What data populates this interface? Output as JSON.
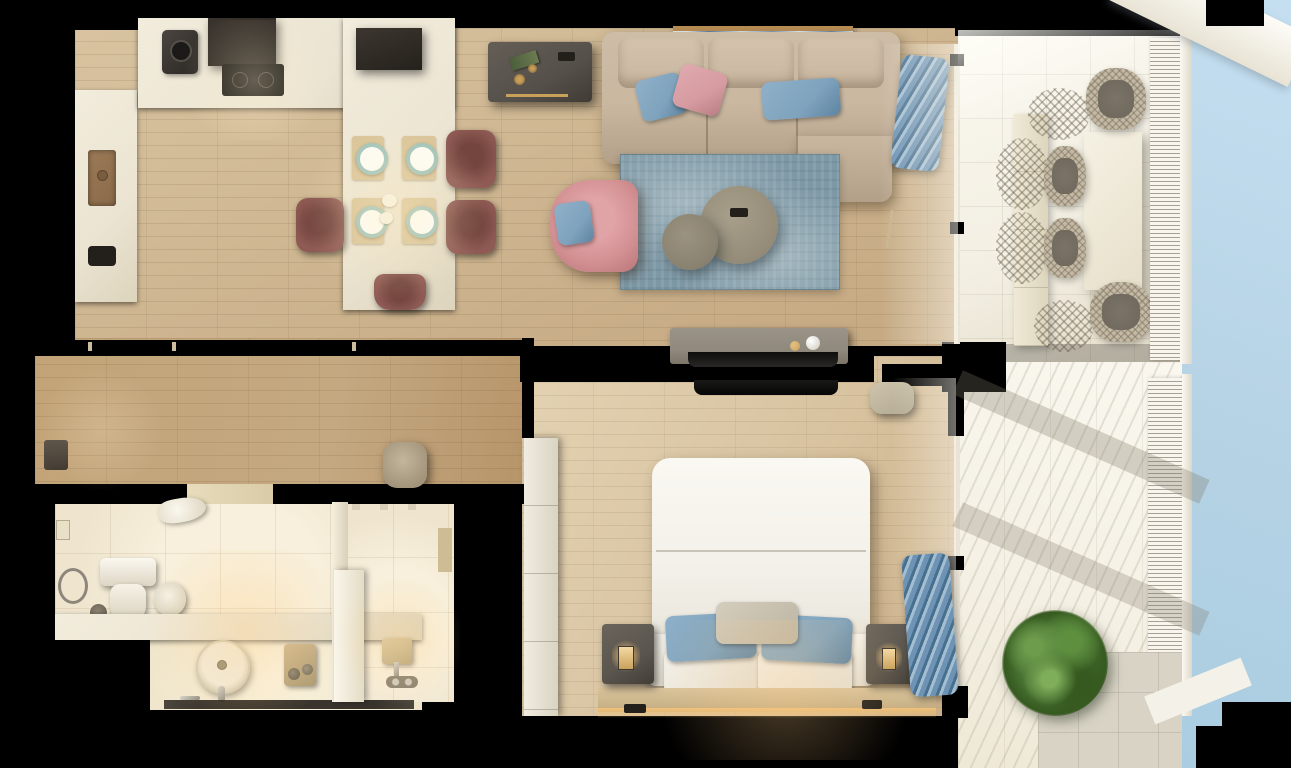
{
  "scene": {
    "description": "Top-down 3D cutaway render of a one-bedroom apartment with balcony",
    "background": "#000000"
  },
  "palette": {
    "black": "#000000",
    "dark": "#23201c",
    "sky": "#b6d3e5",
    "wood": "#c4a881",
    "woodLight": "#d8c3a0",
    "counter": "#ebe4d2",
    "tile": "#efe5cf",
    "tileBright": "#f8f0dc",
    "sofa": "#c9b7a0",
    "cushionBlue": "#7fa3bd",
    "cushionPink": "#d59ba0",
    "armchairPink": "#d28f92",
    "rugBlue": "#7e99a6",
    "chairMauve": "#8f5a54",
    "chairMauveDark": "#74453f",
    "placemat": "#d9c49a",
    "plateRim": "#9fc3bb",
    "desk": "#55504a",
    "consoleGray": "#90897d",
    "bedWhite": "#f3f0e9",
    "nightstand": "#5a554d",
    "curtainBlue": "#6e93b4",
    "curtainDark": "#47708f",
    "balconyFloor": "#f3efe3",
    "balconyGray": "#d8d3c5",
    "rattan": "#c3b9a5",
    "rattanSeat": "#6e675c",
    "plantGreen": "#4c7736",
    "plantGreenDark": "#35591f",
    "gold": "#c9a05a",
    "ledAmber": "#f2c178",
    "brassSink": "#8a6a4a",
    "artBlue": "#5b7fa6"
  },
  "rooms": {
    "openplan": {
      "name": "Open-plan kitchen, dining and living area"
    },
    "kitchen": {
      "name": "Kitchen"
    },
    "dining": {
      "name": "Dining area"
    },
    "living": {
      "name": "Living room"
    },
    "hallway": {
      "name": "Hallway"
    },
    "bathroom": {
      "name": "Bathroom"
    },
    "showerroom": {
      "name": "Shower room"
    },
    "bedroom": {
      "name": "Bedroom"
    },
    "balcony": {
      "name": "Balcony terrace"
    },
    "sky": {
      "name": "Sky"
    }
  },
  "furniture": {
    "sofa": {
      "name": "Beige sectional sofa with chaise"
    },
    "armchair": {
      "name": "Pink armchair with blue pillow"
    },
    "rug": {
      "name": "Blue distressed area rug"
    },
    "coffeeTableBig": {
      "name": "Large round coffee table"
    },
    "coffeeTableSmall": {
      "name": "Small round coffee table"
    },
    "desk": {
      "name": "Dark desk with book and cups"
    },
    "artwork": {
      "name": "Seascape painting leaning on wall"
    },
    "diningTable": {
      "name": "Stone dining table with four place settings"
    },
    "diningChair": {
      "name": "Mauve dining chair"
    },
    "kitchenCounter": {
      "name": "Kitchen counter"
    },
    "cooktop": {
      "name": "Induction cooktop"
    },
    "hood": {
      "name": "Range hood"
    },
    "coffeeMachine": {
      "name": "Coffee machine"
    },
    "kitchenSink": {
      "name": "Brass kitchen sink"
    },
    "tvConsole": {
      "name": "TV console with decor spheres"
    },
    "tvLiving": {
      "name": "TV facing living room"
    },
    "tvBedroom": {
      "name": "TV facing bedroom"
    },
    "laundryBasket": {
      "name": "Laundry basket"
    },
    "pouf": {
      "name": "Hallway pouf"
    },
    "entranceDoor": {
      "name": "Entrance door"
    },
    "bed": {
      "name": "Double bed with blue pillows"
    },
    "headboardLedge": {
      "name": "Headboard ledge with LED strip"
    },
    "nightstandLeft": {
      "name": "Left nightstand with lamp"
    },
    "nightstandRight": {
      "name": "Right nightstand with lamp"
    },
    "wardrobe": {
      "name": "Bedroom wardrobe"
    },
    "curtainLiving": {
      "name": "Blue curtain (living room window)"
    },
    "curtainBedroom": {
      "name": "Blue curtain (bedroom window)"
    },
    "toilet": {
      "name": "Wall-hung toilet"
    },
    "toiletPaper": {
      "name": "Toilet paper roll"
    },
    "towelRing": {
      "name": "Towel ring"
    },
    "vanity": {
      "name": "Bathroom vanity counter"
    },
    "washbasin": {
      "name": "Round washbasin"
    },
    "showerGlass": {
      "name": "Shower glass screen"
    },
    "showerHead": {
      "name": "Shower fixture"
    },
    "outdoorTable": {
      "name": "Outdoor dining table"
    },
    "outdoorChair": {
      "name": "Woven outdoor chair"
    },
    "bench": {
      "name": "Balcony bench planter"
    },
    "railing": {
      "name": "Balcony railing"
    },
    "plant": {
      "name": "Green potted shrub"
    }
  }
}
